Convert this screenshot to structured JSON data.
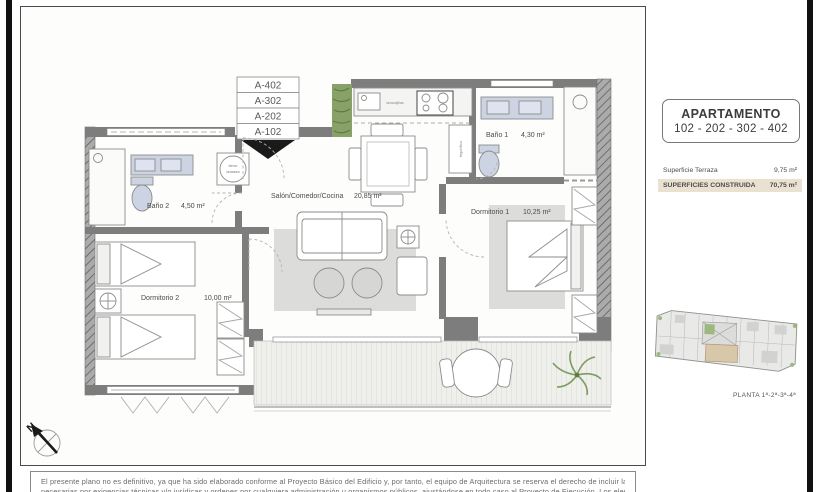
{
  "plan": {
    "unit_stack": [
      "A-402",
      "A-302",
      "A-202",
      "A-102"
    ],
    "rooms": {
      "bano2": {
        "name": "Baño 2",
        "area": "4,50 m²"
      },
      "dorm2": {
        "name": "Dormitorio 2",
        "area": "10,00 m²"
      },
      "salon": {
        "name": "Salón/Comedor/Cocina",
        "area": "20,85 m²"
      },
      "bano1": {
        "name": "Baño 1",
        "area": "4,30 m²"
      },
      "dorm1": {
        "name": "Dormitorio 1",
        "area": "10,25 m²"
      }
    },
    "appliances": {
      "termo": "termo",
      "lavadora": "lavadora",
      "lavavajillas": "lavavajillas",
      "frigorifico": "frigorífico"
    },
    "north_label": "N"
  },
  "info_panel": {
    "title": "APARTAMENTO",
    "units": "102 - 202 - 302 - 402",
    "rows": [
      {
        "label": "Superficie Terraza",
        "value": "9,75 m²"
      },
      {
        "label": "SUPERFICIES CONSTRUIDA",
        "value": "70,75 m²"
      }
    ],
    "keyplan_caption": "PLANTA 1ª-2ª-3ª-4ª"
  },
  "disclaimer": {
    "line1": "El presente plano no es definitivo, ya que ha sido elaborado conforme al Proyecto Básico del Edificio y, por tanto, el equipo de Arquitectura se reserva el derecho de incluir las modificaciones",
    "line2": "necesarias por exigencias técnicas y/o jurídicas y ordenes por cualquiera administración u organismos públicos, ajustándose en todo caso al Proyecto de Ejecución. Los elementos como mobiliario"
  },
  "colors": {
    "wall": "#7d7d7d",
    "fixture_blue": "#ccd4e4",
    "highlight_beige": "#eae1d0",
    "keyplan_tan": "#d9c7aa",
    "plant_green": "#87a167"
  }
}
